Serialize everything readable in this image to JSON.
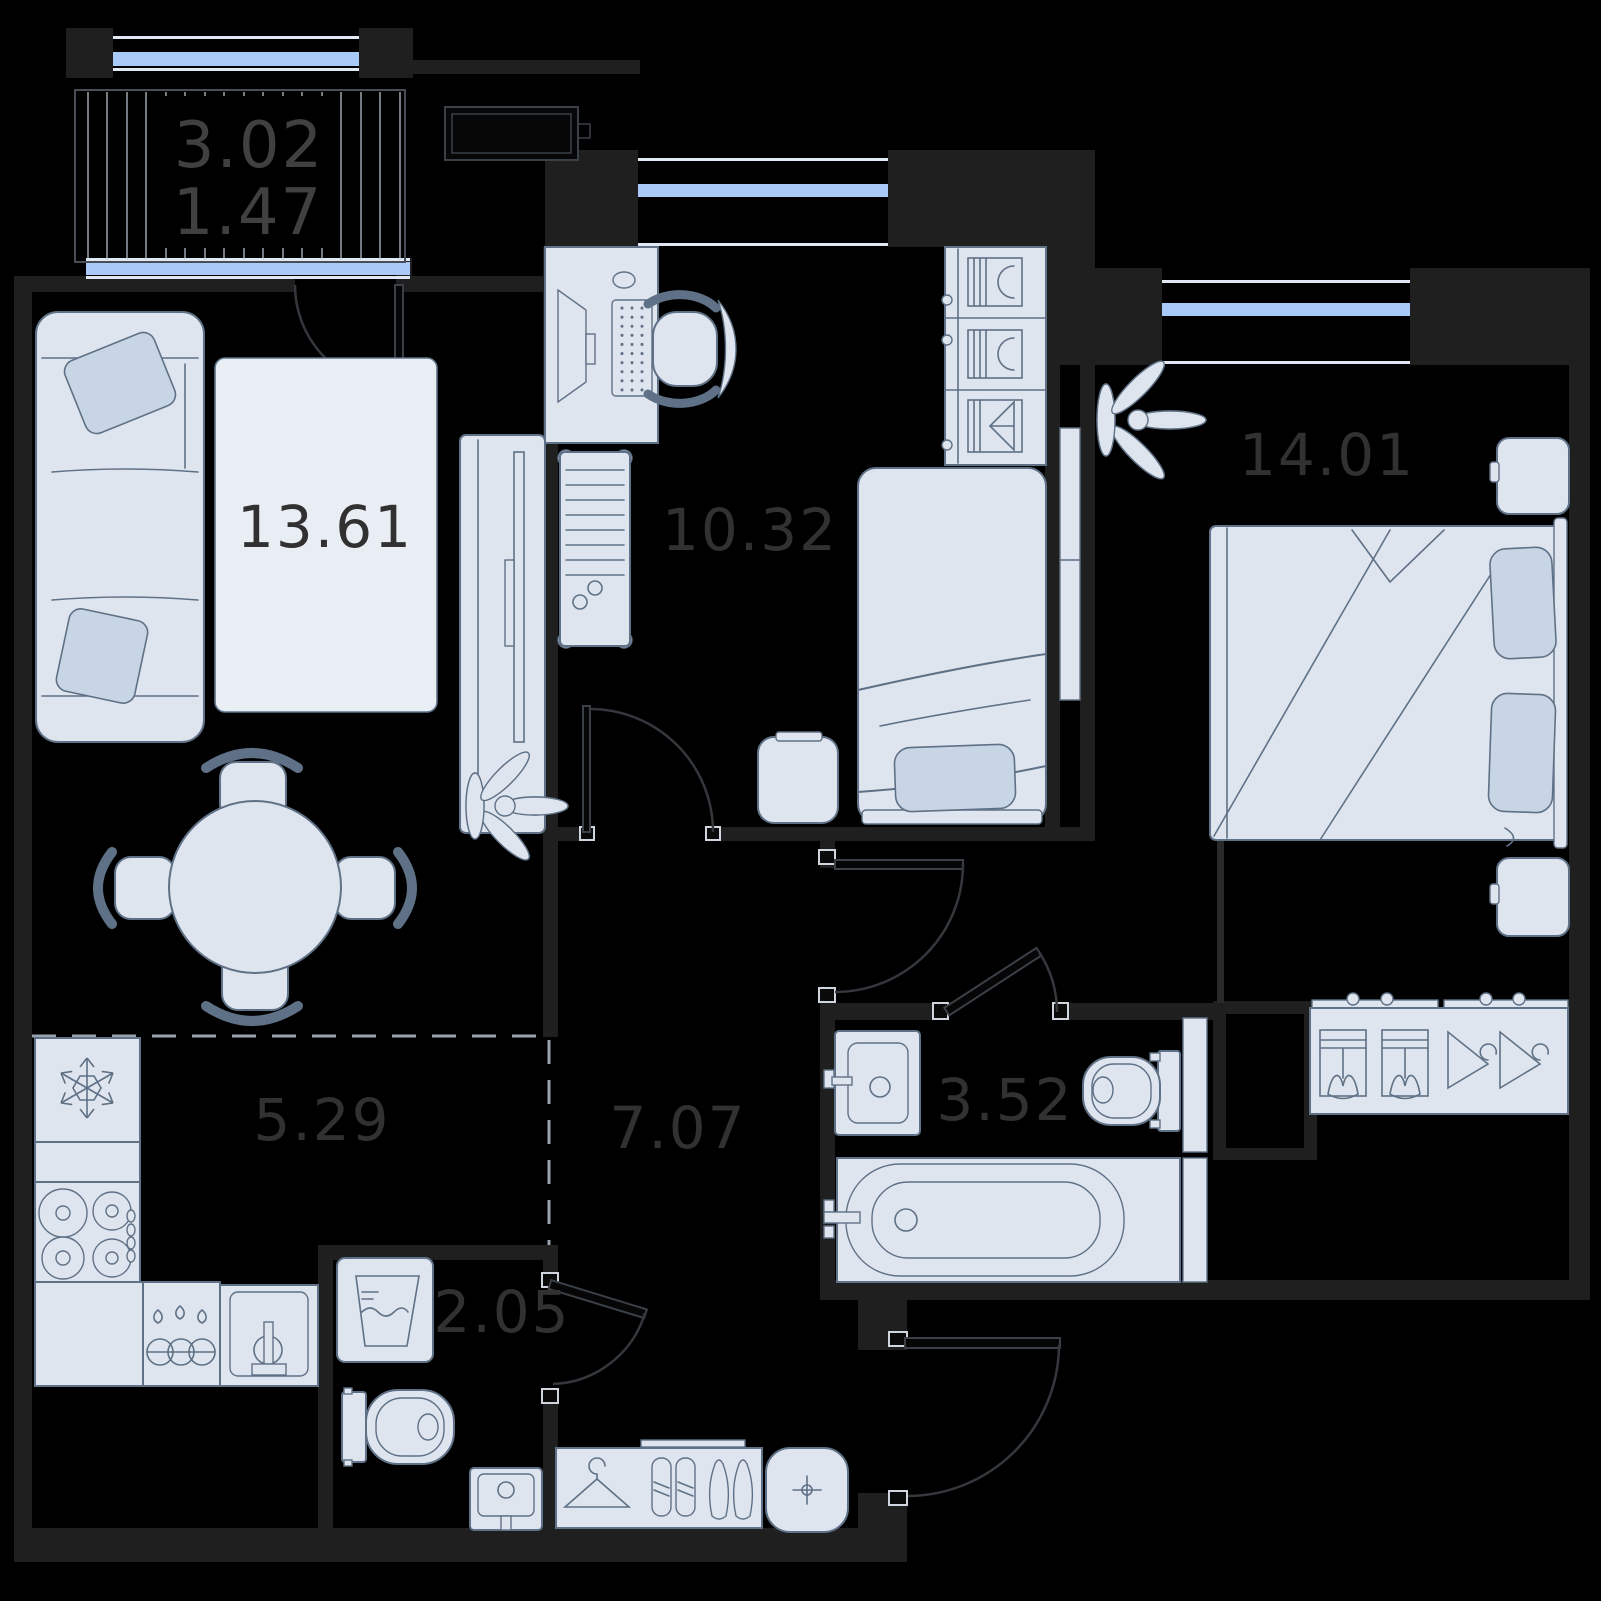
{
  "plan_title": "2-room apartment floor plan",
  "rooms": {
    "balcony": {
      "area_total": "3.02",
      "area_reduced": "1.47"
    },
    "living_room": {
      "area": "13.61"
    },
    "study": {
      "area": "10.32"
    },
    "bedroom": {
      "area": "14.01"
    },
    "kitchen": {
      "area": "5.29"
    },
    "hallway": {
      "area": "7.07"
    },
    "bathroom": {
      "area": "3.52"
    },
    "wc": {
      "area": "2.05"
    }
  },
  "colors": {
    "background": "#000000",
    "wall": "#1f1f1f",
    "furniture_fill": "#dfe5ee",
    "furniture_stroke": "#5f7186",
    "pillow_fill": "#c7d5e4",
    "rug_fill": "#e9eef5",
    "window_glass": "#a9caf8",
    "window_frame": "#dfe8f3",
    "label": "#313131",
    "door_arc": "#34383d",
    "hatch": "#c5cedb",
    "dash": "#9aa3ad"
  }
}
